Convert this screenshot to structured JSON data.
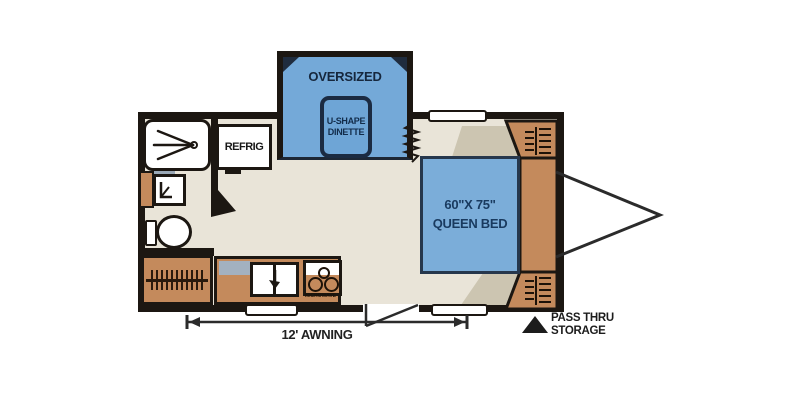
{
  "diagram": {
    "type": "travel-trailer floor plan",
    "labels": {
      "oversized": "OVERSIZED",
      "dinette": [
        "U-SHAPE",
        "DINETTE"
      ],
      "refrig": "REFRIG",
      "bed": [
        "60\"X 75\"",
        "QUEEN BED"
      ],
      "microwave": "MICROWAVE",
      "awning": "12' AWNING",
      "pass_thru": [
        "PASS THRU",
        "STORAGE"
      ]
    },
    "colors": {
      "wall": "#1c1712",
      "slide_blue": "#74a9d8",
      "bed_blue": "#7badd9",
      "navy_text": "#16273d",
      "floor": "#e9e4d8",
      "floor_shadow": "#ccc5b1",
      "cabinet_brown": "#c48a5c",
      "backsplash_gray": "#a3b1c0",
      "annotation": "#1c1c1c"
    },
    "icons": [
      "shower-head-icon",
      "toilet-icon",
      "double-sink-icon",
      "stove-burners-icon",
      "hanging-clothes-icon",
      "shelf-icon",
      "slide-bellows-icon",
      "hitch-tongue-icon",
      "dimension-arrow-icon",
      "triangle-marker-icon",
      "door-swing-icon"
    ]
  }
}
